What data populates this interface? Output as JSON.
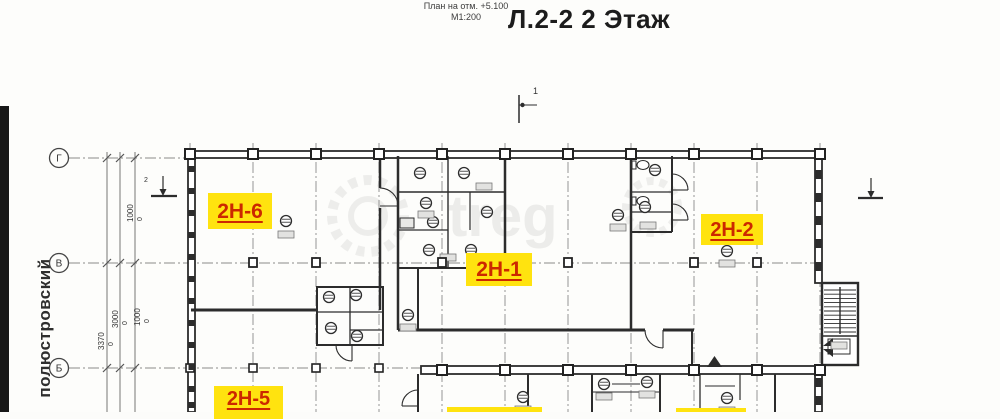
{
  "title_block": {
    "plan_note": "План на отм. +5.100",
    "scale": "М1:200",
    "floor_title": "Л.2-2 2 Этаж"
  },
  "street_label": "полюстровский",
  "axis_rows": [
    {
      "label": "Г"
    },
    {
      "label": "В"
    },
    {
      "label": "Б"
    }
  ],
  "units": [
    {
      "id": "2Н-6"
    },
    {
      "id": "2Н-1"
    },
    {
      "id": "2Н-2"
    },
    {
      "id": "2Н-5"
    }
  ],
  "dimensions": {
    "upper": [
      {
        "value": "1000",
        "offset": "0"
      }
    ],
    "lower": [
      {
        "value": "3370",
        "offset": "0"
      },
      {
        "value": "3000",
        "offset": "0"
      },
      {
        "value": "1000",
        "offset": "0"
      }
    ]
  },
  "marks": {
    "section_number": "1",
    "benchmark_number": "2"
  },
  "watermark": {
    "text": "treg"
  },
  "colors": {
    "highlight_bg": "#ffe30f",
    "highlight_text": "#cc2800",
    "ink": "#2c2c2c",
    "paper": "#fcfcfa"
  }
}
